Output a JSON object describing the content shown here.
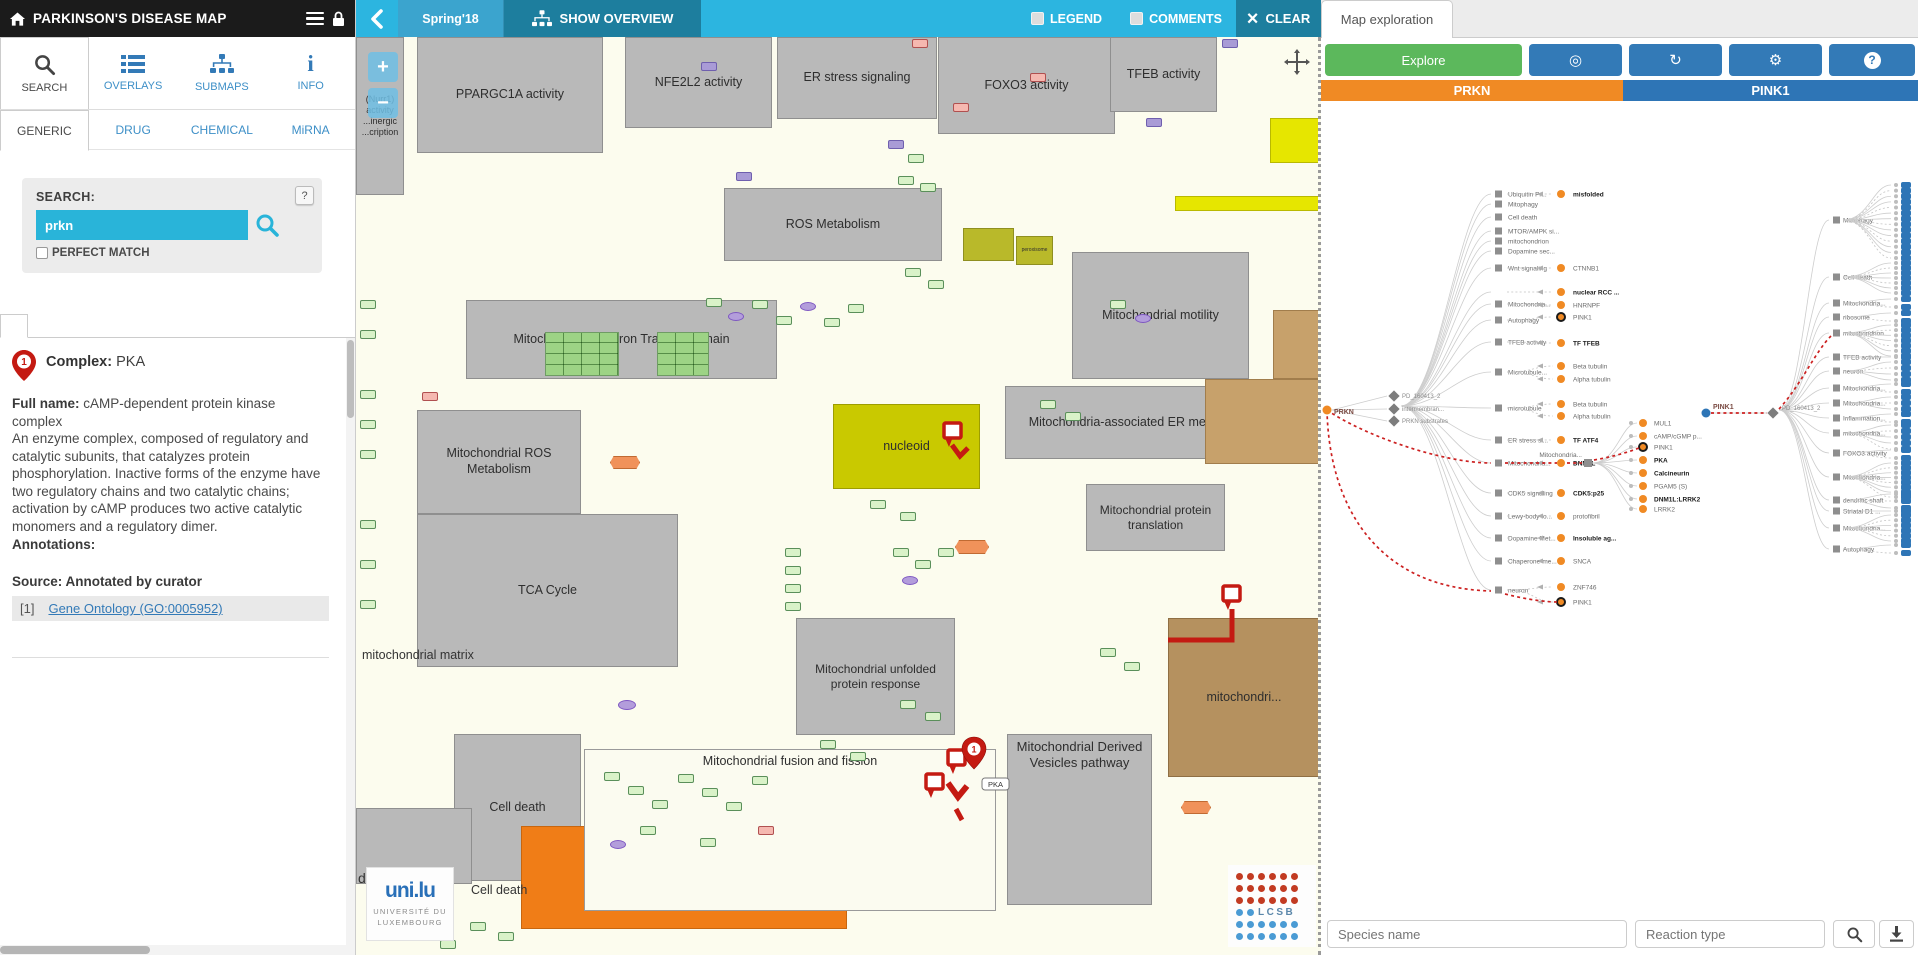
{
  "header": {
    "title": "PARKINSON'S DISEASE MAP"
  },
  "nav": {
    "items": [
      {
        "label": "SEARCH",
        "icon": "search-icon"
      },
      {
        "label": "OVERLAYS",
        "icon": "overlays-icon"
      },
      {
        "label": "SUBMAPS",
        "icon": "submaps-icon"
      },
      {
        "label": "INFO",
        "icon": "info-icon"
      }
    ]
  },
  "tabs": {
    "items": [
      "GENERIC",
      "DRUG",
      "CHEMICAL",
      "MiRNA"
    ],
    "active": "GENERIC"
  },
  "search": {
    "label": "SEARCH:",
    "value": "prkn",
    "help": "?",
    "perfect_match": "PERFECT MATCH"
  },
  "result": {
    "marker": "1",
    "type_label": "Complex:",
    "name": " PKA",
    "full_name_label": "Full name: ",
    "full_name": "cAMP-dependent protein kinase complex",
    "description": "An enzyme complex, composed of regulatory and catalytic subunits, that catalyzes protein phosphorylation. Inactive forms of the enzyme have two regulatory chains and two catalytic chains; activation by cAMP produces two active catalytic monomers and a regulatory dimer.",
    "annotations_label": "Annotations:",
    "source_label": "Source: Annotated by curator",
    "ref_index": "[1]",
    "ref_link": "Gene Ontology (GO:0005952)"
  },
  "map": {
    "topbar": {
      "version": "Spring'18",
      "show_overview": "SHOW OVERVIEW",
      "legend": "LEGEND",
      "comments": "COMMENTS",
      "clear": "CLEAR"
    },
    "zoom_in": "+",
    "zoom_out": "−",
    "compartments": [
      {
        "id": "nurr1",
        "label": "(Nurr1) activity ...inergic ...cription"
      },
      {
        "id": "ppargc1a",
        "label": "PPARGC1A activity"
      },
      {
        "id": "nfe2l2",
        "label": "NFE2L2 activity"
      },
      {
        "id": "erstress",
        "label": "ER stress signaling"
      },
      {
        "id": "foxo3",
        "label": "FOXO3 activity"
      },
      {
        "id": "tfeb",
        "label": "TFEB activity"
      },
      {
        "id": "rosmet",
        "label": "ROS Metabolism"
      },
      {
        "id": "metc",
        "label": "Mitochondrial Electron Transport Chain"
      },
      {
        "id": "motility",
        "label": "Mitochondrial motility"
      },
      {
        "id": "maer",
        "label": "Mitochondria-associated ER membrane"
      },
      {
        "id": "mitoros",
        "label": "Mitochondrial ROS Metabolism"
      },
      {
        "id": "nucleoid",
        "label": "nucleoid"
      },
      {
        "id": "mitotrans",
        "label": "Mitochondrial protein translation"
      },
      {
        "id": "tca",
        "label": "TCA Cycle"
      },
      {
        "id": "unfold",
        "label": "Mitochondrial unfolded protein response"
      },
      {
        "id": "celldeath",
        "label": "Cell death"
      },
      {
        "id": "mdv",
        "label": "Mitochondrial Derived Vesicles pathway"
      },
      {
        "id": "matrixor",
        "label": "mitochondrial matrix"
      },
      {
        "id": "brownbig",
        "label": "mitochondri..."
      },
      {
        "id": "tanbox",
        "label": ""
      },
      {
        "id": "tansm",
        "label": ""
      },
      {
        "id": "fusion",
        "label": "Mitochondrial fusion and fission"
      },
      {
        "id": "peroxi",
        "label": "peroxisome"
      },
      {
        "id": "olive2",
        "label": ""
      },
      {
        "id": "ybar",
        "label": ""
      },
      {
        "id": "ybox",
        "label": ""
      },
      {
        "id": "graysm",
        "label": ""
      }
    ],
    "labels": [
      {
        "id": "matrix_beige",
        "text": "mitochondrial matrix"
      },
      {
        "id": "death",
        "text": "death"
      },
      {
        "id": "celldeath2",
        "text": "Cell death"
      }
    ],
    "markers": {
      "pin_number": "1",
      "pka_label": "PKA"
    },
    "logos": {
      "unilu": "uni.lu",
      "unilu_line1": "UNIVERSITÉ DU",
      "unilu_line2": "LUXEMBOURG",
      "lcsb": "LCSB"
    }
  },
  "explore": {
    "tab": "Map exploration",
    "explore_label": "Explore",
    "genes": {
      "left": "PRKN",
      "right": "PINK1"
    },
    "footer": {
      "species_placeholder": "Species name",
      "reaction_placeholder": "Reaction type"
    },
    "tree": {
      "left_root": {
        "label": "PRKN",
        "y": 410
      },
      "left_hubs": [
        {
          "label": "PD_160413_2",
          "y": 396
        },
        {
          "label": "intermembran...",
          "y": 409
        },
        {
          "label": "PRKN substrates",
          "y": 421
        }
      ],
      "left_categories": [
        {
          "label": "Ubiquitin Pr...",
          "y": 194,
          "children": [
            {
              "label": "misfolded",
              "y": 194,
              "bold": true
            }
          ]
        },
        {
          "label": "Mitophagy",
          "y": 204
        },
        {
          "label": "Cell death",
          "y": 217
        },
        {
          "label": "MTOR/AMPK si...",
          "y": 231
        },
        {
          "label": "mitochondrion",
          "y": 241
        },
        {
          "label": "Dopamine sec...",
          "y": 251
        },
        {
          "label": "Wnt signaling",
          "y": 268,
          "children": [
            {
              "label": "CTNNB1",
              "y": 268
            }
          ]
        },
        {
          "label": "",
          "y": 292,
          "nosquare": true,
          "children": [
            {
              "label": "nuclear RCC ...",
              "y": 292,
              "bold": true
            }
          ]
        },
        {
          "label": "Mitochondria...",
          "y": 304,
          "children": [
            {
              "label": "HNRNPF",
              "y": 305
            }
          ]
        },
        {
          "label": "Autophagy",
          "y": 320,
          "children": [
            {
              "label": "PINK1",
              "y": 317,
              "ring": true
            }
          ]
        },
        {
          "label": "TFEB activity",
          "y": 342,
          "children": [
            {
              "label": "TF TFEB",
              "y": 343,
              "bold": true
            }
          ]
        },
        {
          "label": "Microtubule...",
          "y": 372,
          "children": [
            {
              "label": "Beta tubulin",
              "y": 366
            },
            {
              "label": "Alpha tubulin",
              "y": 379
            }
          ]
        },
        {
          "label": "microtubule",
          "y": 408,
          "children": [
            {
              "label": "Beta tubulin",
              "y": 404
            },
            {
              "label": "Alpha tubulin",
              "y": 416
            }
          ]
        },
        {
          "label": "ER stress si...",
          "y": 440,
          "children": [
            {
              "label": "TF ATF4",
              "y": 440,
              "bold": true
            }
          ]
        },
        {
          "label": "Mitochondria...",
          "y": 463,
          "red": true,
          "children": [
            {
              "label": "DNM1L",
              "y": 463,
              "bold": true,
              "red": true
            }
          ]
        },
        {
          "label": "CDK5 signaling",
          "y": 493,
          "children": [
            {
              "label": "CDK5:p25",
              "y": 493,
              "bold": true
            }
          ]
        },
        {
          "label": "Lewy-body fo...",
          "y": 516,
          "children": [
            {
              "label": "protofibril",
              "y": 516
            }
          ]
        },
        {
          "label": "Dopamine Met...",
          "y": 538,
          "children": [
            {
              "label": "Insoluble ag...",
              "y": 538,
              "bold": true
            }
          ]
        },
        {
          "label": "Chaperone-me...",
          "y": 561,
          "children": [
            {
              "label": "SNCA",
              "y": 561
            }
          ]
        },
        {
          "label": "neuron",
          "y": 590,
          "children": [
            {
              "label": "ZNF746",
              "y": 587
            },
            {
              "label": "PINK1",
              "y": 602,
              "ring": true
            }
          ]
        }
      ],
      "mid_hub": {
        "label": "Mitochondria...",
        "y": 463
      },
      "mid_children": [
        {
          "label": "MUL1",
          "y": 423
        },
        {
          "label": "cAMP/cGMP p...",
          "y": 436
        },
        {
          "label": "PINK1",
          "y": 447,
          "ring": true
        },
        {
          "label": "PKA",
          "y": 460,
          "bold": true
        },
        {
          "label": "Calcineurin",
          "y": 473,
          "bold": true
        },
        {
          "label": "PGAM5 (S)",
          "y": 486
        },
        {
          "label": "DNM1L:LRRK2",
          "y": 499,
          "bold": true
        },
        {
          "label": "LRRK2",
          "y": 509
        }
      ],
      "right_root": {
        "label": "PINK1",
        "y": 413
      },
      "right_hub": {
        "label": "PD_160413_2",
        "y": 413
      },
      "right_categories": [
        {
          "label": "Mitophagy",
          "y": 220,
          "dots": 14,
          "spread": [
            185,
            258
          ]
        },
        {
          "label": "Cell death",
          "y": 277,
          "dots": 7,
          "spread": [
            263,
            293
          ]
        },
        {
          "label": "Mitochondria...",
          "y": 303,
          "dots": 2,
          "spread": [
            299,
            307
          ]
        },
        {
          "label": "ribosome",
          "y": 317,
          "dots": 2,
          "spread": [
            313,
            321
          ]
        },
        {
          "label": "mitochondrion",
          "y": 333,
          "dots": 7,
          "spread": [
            325,
            356
          ],
          "red": true
        },
        {
          "label": "TFEB activity",
          "y": 357,
          "dots": 1,
          "spread": [
            357,
            357
          ]
        },
        {
          "label": "neuron",
          "y": 371,
          "dots": 4,
          "spread": [
            362,
            380
          ]
        },
        {
          "label": "Mitochondria...",
          "y": 388,
          "dots": 2,
          "spread": [
            384,
            392
          ]
        },
        {
          "label": "Mitochondria...",
          "y": 403,
          "dots": 3,
          "spread": [
            397,
            409
          ]
        },
        {
          "label": "Inflammation...",
          "y": 418,
          "dots": 2,
          "spread": [
            414,
            422
          ]
        },
        {
          "label": "mitochondria...",
          "y": 433,
          "dots": 5,
          "spread": [
            425,
            449
          ]
        },
        {
          "label": "FOXO3 activity",
          "y": 453,
          "dots": 2,
          "spread": [
            450,
            458
          ]
        },
        {
          "label": "Mitochondria...",
          "y": 477,
          "dots": 8,
          "spread": [
            463,
            497
          ]
        },
        {
          "label": "dendritic shaft",
          "y": 500,
          "dots": 3,
          "spread": [
            494,
            508
          ]
        },
        {
          "label": "Striatal D1 ...",
          "y": 511,
          "dots": 1,
          "spread": [
            511,
            511
          ]
        },
        {
          "label": "Mitochondria...",
          "y": 528,
          "dots": 6,
          "spread": [
            515,
            541
          ]
        },
        {
          "label": "Autophagy",
          "y": 549,
          "dots": 2,
          "spread": [
            545,
            553
          ]
        }
      ]
    }
  },
  "colors": {
    "accent_cyan": "#2cb5e0",
    "dark_teal": "#1d7e9e",
    "orange": "#f08a24",
    "blue": "#2e75b6",
    "green": "#5cb85c",
    "link": "#337ab7",
    "marker_red": "#c41a12"
  }
}
